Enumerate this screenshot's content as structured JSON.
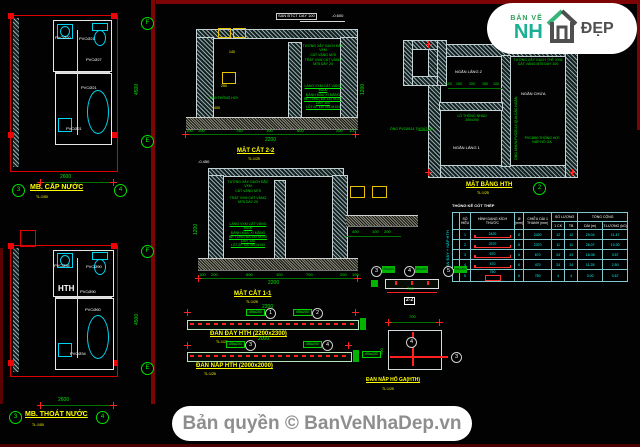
{
  "footer": {
    "copyright": "Bản quyền © BanVeNhaDep.vn"
  },
  "logo": {
    "small": "BẢN VẼ",
    "left": "NH",
    "right": "ĐẸP"
  },
  "plan_cap_nuoc": {
    "title": "MB. CẤP NƯỚC",
    "scale": "TL:1/50",
    "dim_width": "2600",
    "dim_height": "4500",
    "grid_f": "F",
    "grid_e": "E",
    "grid_3": "3",
    "grid_4": "4",
    "pipes": [
      "PVCØ20",
      "PVCØ21",
      "PVCØ27",
      "PVCØ21",
      "PVCØ21"
    ]
  },
  "plan_thoat_nuoc": {
    "title": "MB. THOÁT NƯỚC",
    "scale": "TL:1/50",
    "dim_width": "2600",
    "dim_height": "4500",
    "room_label": "HTH",
    "grid_f": "F",
    "grid_e": "E",
    "grid_3": "3",
    "grid_4": "4",
    "pipes": [
      "PVCØ34",
      "PVCØ90",
      "PVCØ90",
      "PVCØ60",
      "PVCØ34"
    ]
  },
  "section_2_2": {
    "title": "MẶT CẮT 2-2",
    "scale": "TL:1/25",
    "slab_note": "SÀN BTCT DÀY 100",
    "level": "-0.600",
    "vent_note": "Ø60 THÔNG HƠI",
    "note_wall_1": "TƯỜNG XÂY GẠCH ĐẶC VXM",
    "note_wall_2": "CÁT VÀNG M75",
    "note_plaster_1": "TRÁT VXM CÁT VÀNG",
    "note_plaster_2": "M75 DÀY 20",
    "note_lining_1": "LÁNG VXM CÁT VÀNG M100",
    "note_lining_2": "ĐÁNH MÀU XI MĂNG",
    "note_lining_3": "BÊ TÔNG ĐÁ 1x2 M200 DÀY 100",
    "note_lining_4": "LÓT BT ĐÁ 4x6 M100",
    "inner_dim_1": "140",
    "inner_dim_2": "250",
    "inner_dim_3": "400",
    "dims": [
      "100",
      "200",
      "750",
      "100",
      "800",
      "200",
      "100"
    ],
    "dim_total": "2200",
    "dim_right": "1200"
  },
  "section_1_1": {
    "title": "MẶT CẮT 1-1",
    "scale": "TL:1/25",
    "level": "-0.450",
    "note_wall_1": "TƯỜNG XÂY GẠCH ĐẶC VXM",
    "note_wall_2": "CÁT VÀNG M75",
    "note_plaster_1": "TRÁT VXM CÁT VÀNG",
    "note_plaster_2": "M75 DÀY 20",
    "note_lining_1": "LÁNG VXM CÁT VÀNG M100",
    "note_lining_2": "ĐÁNH MÀU XI MĂNG",
    "note_lining_3": "BÊ TÔNG ĐÁ 1x2 M200 DÀY 100",
    "note_lining_4": "LÓT BT ĐÁ 4x6 M100",
    "dims": [
      "100",
      "200",
      "800",
      "100",
      "700",
      "200",
      "100"
    ],
    "dim_total": "2200",
    "dim_left": "1200",
    "dims_right": [
      "400",
      "100",
      "200"
    ]
  },
  "dan_day": {
    "title": "ĐAN ĐÁY HTH (2200x2300)",
    "scale": "TL:1/25",
    "dim": "2200",
    "callout_a": "1",
    "callout_a_label": "Ø8a200",
    "callout_b": "2",
    "callout_b_label": "Ø8a200"
  },
  "dan_nap": {
    "title": "ĐAN NẮP HTH (2000x2000)",
    "scale": "TL:1/25",
    "dim": "2000",
    "callout_a": "3",
    "callout_a_label": "Ø8a200",
    "callout_b": "4",
    "callout_b_label": "Ø8a200"
  },
  "mat_bang_hth": {
    "title": "MẶT BẰNG HTH",
    "scale": "TL:1/25",
    "room_1": "NGĂN LẮNG 2",
    "room_2": "NGĂN CHỨA",
    "room_3": "NGĂN LẮNG 1",
    "note_wall_1": "TƯỜNG XÂY GẠCH THẺ VXM",
    "note_wall_2": "CÁT VÀNG M75 DÀY 100",
    "note_hole_1": "LỖ THÔNG NHAU",
    "note_hole_2": "200x200",
    "note_pipe_out": "ỐNG PVCØ114 THOÁT RA",
    "note_pipe_through": "ỐNG NHỰA PVCØ114 QUA CÁC NGĂN",
    "note_vent_1": "PVCØ60 THÔNG HƠI",
    "note_vent_2": "NẮP HỐ GA",
    "dims_top": [
      "100",
      "150",
      "200",
      "150",
      "100"
    ],
    "section_mark": "2"
  },
  "steel_table": {
    "title": "THỐNG KÊ CỐT THÉP",
    "member_label": "ĐAN ĐÁY + NẮP HTH",
    "headers": {
      "no": "SỐ HIỆU",
      "shape": "HÌNH DẠNG KÍCH THƯỚC",
      "dia": "Ø (mm)",
      "len": "CHIỀU DÀI 1 THANH (mm)",
      "qty": "SỐ LƯỢNG",
      "qty1": "1 CK",
      "qtyAll": "TB",
      "total": "TỔNG CỘNG",
      "tlen": "DÀI (m)",
      "tweight": "T.LƯỢNG (kG)"
    },
    "rows": [
      {
        "no": "1",
        "shape_len": "2420",
        "dia": "8",
        "len": "2420",
        "q1": "12",
        "qa": "12",
        "tl": "29.04",
        "tw": "11.47"
      },
      {
        "no": "2",
        "shape_len": "2370",
        "dia": "8",
        "len": "2370",
        "q1": "11",
        "qa": "11",
        "tl": "26.07",
        "tw": "10.30"
      },
      {
        "no": "3",
        "shape_len": "670",
        "dia": "6",
        "len": "670",
        "q1": "24",
        "qa": "24",
        "tl": "16.08",
        "tw": "3.57"
      },
      {
        "no": "4",
        "shape_len": "470",
        "dia": "6",
        "len": "470",
        "q1": "24",
        "qa": "24",
        "tl": "11.28",
        "tw": "2.50"
      },
      {
        "no": "5",
        "shape_len": "750",
        "dia": "6",
        "len": "750",
        "q1": "4",
        "qa": "4",
        "tl": "3.00",
        "tw": "0.67"
      }
    ]
  },
  "beam_2_2": {
    "label": "2-2",
    "dim": "730",
    "callout_1": "3",
    "callout_2": "4",
    "callout_3": "5",
    "label_1": "Ø6a200",
    "label_2": "Ø6a200",
    "label_3": "Ø6a200"
  },
  "dan_nap_ho_ga": {
    "title": "ĐAN NẮP HỐ GA(HTH)",
    "scale": "TL:1/25",
    "dim_top": "700",
    "dim_left": "700",
    "callout_a": "4",
    "callout_b": "3",
    "bar_label": "Ø6a200"
  }
}
